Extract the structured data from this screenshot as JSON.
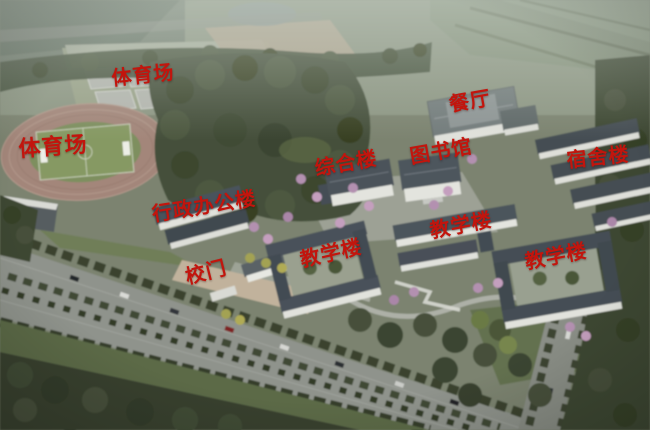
{
  "scene": {
    "type": "aerial-architectural-rendering",
    "description": "Bird's-eye rendering of a school campus master plan annotated with red Chinese place labels"
  },
  "palette": {
    "label_red": "#c2150d",
    "tree_dark": "#3e4733",
    "field_green": "#7e8f5f",
    "track_tan": "#a3867a",
    "road_gray": "#8f938c",
    "roof_gray": "#49515a",
    "wall_white": "#e3e4de",
    "blossom_pink": "#b390b0",
    "gate_plaza_tan": "#c1b29c"
  },
  "labels": [
    {
      "id": "sports-ground-north",
      "text": "体育场"
    },
    {
      "id": "stadium",
      "text": "体育场"
    },
    {
      "id": "dining-hall",
      "text": "餐厅"
    },
    {
      "id": "complex-building",
      "text": "综合楼"
    },
    {
      "id": "library",
      "text": "图书馆"
    },
    {
      "id": "dormitory-building",
      "text": "宿舍楼"
    },
    {
      "id": "admin-office-building",
      "text": "行政办公楼"
    },
    {
      "id": "teaching-building-center",
      "text": "教学楼"
    },
    {
      "id": "teaching-building-west",
      "text": "教学楼"
    },
    {
      "id": "teaching-building-east",
      "text": "教学楼"
    },
    {
      "id": "school-gate",
      "text": "校门"
    }
  ]
}
